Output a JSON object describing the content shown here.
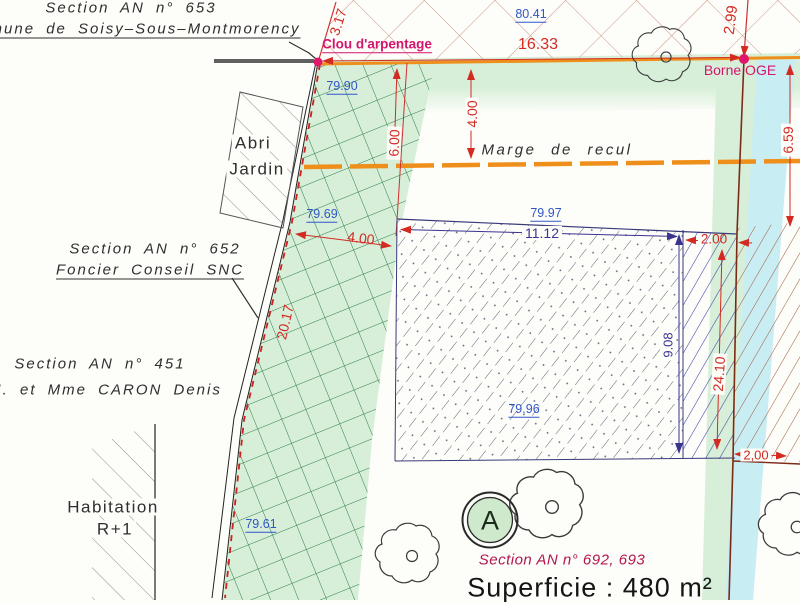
{
  "plan": {
    "labels": {
      "section_653": "Section AN n° 653",
      "commune": "mune de Soisy–Sous–Montmorency",
      "clou": "Clou d'arpentage",
      "borne": "Borne OGE",
      "marge_recul": "Marge de recul",
      "section_652": "Section AN n° 652",
      "owner_652": "Foncier Conseil SNC",
      "section_451": "Section AN n° 451",
      "owner_451": "M. et Mme CARON Denis",
      "abri_line1": "Abri",
      "abri_line2": "Jardin",
      "habitation_line1": "Habitation",
      "habitation_line2": "R+1",
      "lot_letter": "A",
      "section_692": "Section AN n° 692, 693",
      "superficie": "Superficie : 480 m²"
    },
    "dimensions_m": {
      "d317": "3.17",
      "d1633": "16.33",
      "d299": "2.99",
      "d400_recul": "4.00",
      "d600": "6.00",
      "d400_band": "4.00",
      "d2017": "20.17",
      "d1112": "11.12",
      "d200_top": "2.00",
      "d908": "9.08",
      "d2410": "24.10",
      "d659": "6.59",
      "d200_bottom": "2,00"
    },
    "spot_levels_m": {
      "l8041": "80.41",
      "l7990": "79.90",
      "l7969": "79.69",
      "l7997": "79.97",
      "l7996": "79.96",
      "l7961": "79.61"
    },
    "colors": {
      "dimension_red": "#d32a22",
      "marker_magenta": "#d4156e",
      "level_blue": "#3056c8",
      "dimension_navy": "#3a3390",
      "zone_orange": "#ee8f1c",
      "band_green": "#d7efd8",
      "band_cyan": "#c8edf3",
      "hatch_green": "#2e7b49",
      "property_brown": "#7c2a18"
    }
  }
}
